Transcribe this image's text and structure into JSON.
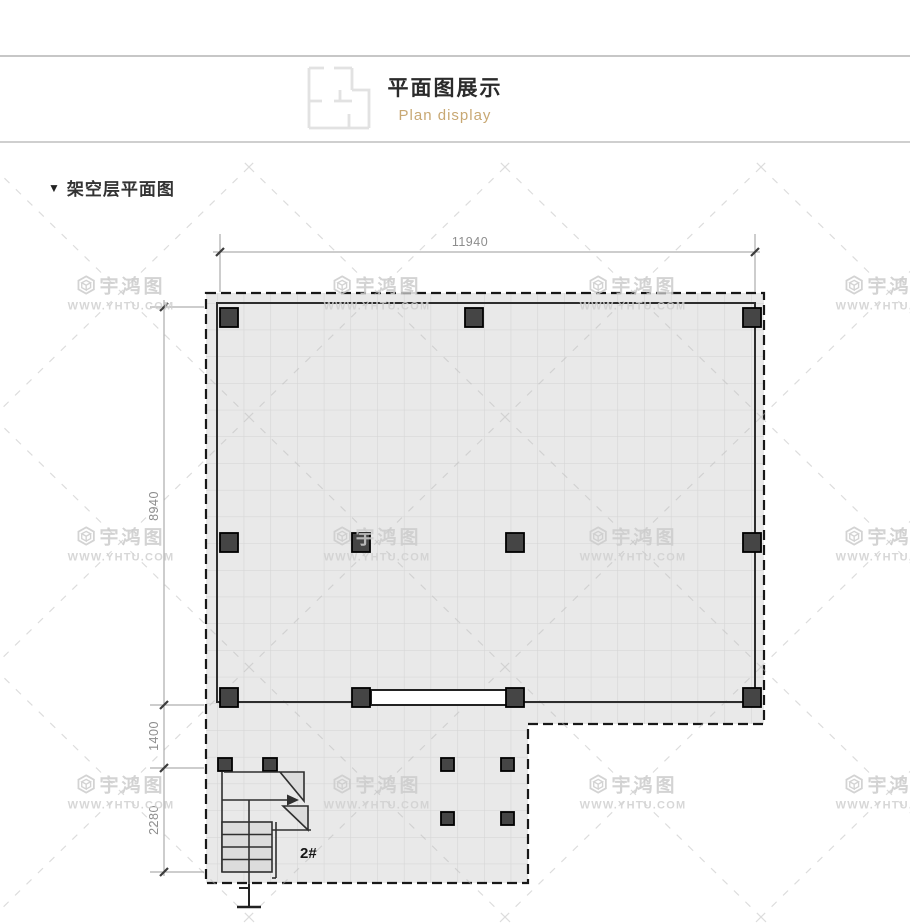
{
  "header": {
    "title": "平面图展示",
    "subtitle": "Plan display",
    "icon": "floorplan-icon"
  },
  "section": {
    "marker": "▼",
    "label": "架空层平面图"
  },
  "plan": {
    "dims": {
      "width_top": "11940",
      "height_main": "8940",
      "height_mid": "1400",
      "height_lower": "2280"
    },
    "stair_label": "2#"
  },
  "watermark": {
    "logo_icon": "hexagon-logo",
    "name": "宇鸿图",
    "url": "WWW.YHTU.COM",
    "color": "#cccccc",
    "grid": {
      "cols": [
        121,
        377,
        633,
        889
      ],
      "rows": [
        292,
        543,
        791
      ]
    }
  },
  "colors": {
    "subtitle_accent": "#c8a873",
    "floor_fill": "#e9e9e9",
    "grid_line": "#d4d4d4",
    "column_fill": "#454545",
    "outline_dashed": "#181818",
    "dimension": "#8d8d8d",
    "watermark": "#cccccc"
  }
}
